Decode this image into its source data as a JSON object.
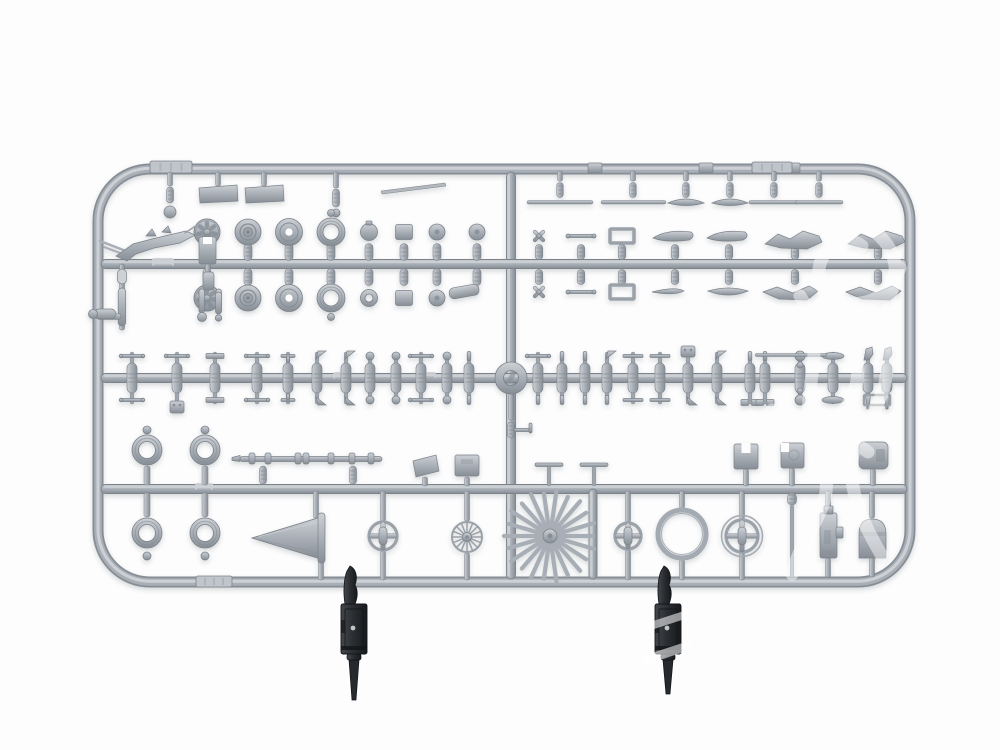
{
  "meta": {
    "description": "Product photograph of a light grey injection-moulded plastic model kit sprue on a white background. The rounded rectangular runner frame holds aircraft detail parts: spoked wheels, rimmed wheels, four rubber-style tyre rings, a propeller spinner cone, a large sunburst spoked wheel, cross-spoke wheels, struts, rods, brackets and fuselage fittings. Two dark grey machine guns are attached at the bottom edge and a faint white watermark swirl overlays the right side."
  },
  "palette": {
    "background": "#fdfdfe",
    "sprue_light": "#cdd1d6",
    "sprue_mid": "#a9afb6",
    "sprue_dark": "#878e96",
    "outline": "#7b828a",
    "tag_fill": "#c0c5cb",
    "dark_hi": "#43474c",
    "dark_mid": "#2b2e32",
    "dark_low": "#17191c",
    "watermark": "#ffffff"
  },
  "scene": {
    "frame": {
      "x": 98,
      "y": 169,
      "w": 812,
      "h": 413,
      "r": 52
    },
    "divider_x": 511,
    "runners_y": [
      264,
      378,
      489
    ],
    "right_vbar_x": 593,
    "tabs_top": [
      595,
      706,
      793
    ],
    "tags": [
      [
        150,
        161,
        42,
        12
      ],
      [
        752,
        162,
        40,
        11
      ],
      [
        196,
        576,
        36,
        11
      ]
    ],
    "marks": [
      [
        152,
        258,
        22,
        8
      ],
      [
        333,
        372,
        16,
        7
      ],
      [
        195,
        483,
        18,
        7
      ],
      [
        424,
        372,
        12,
        6
      ]
    ],
    "gear_assembly": {
      "present": true
    },
    "left_frame_parts": {
      "present": true
    },
    "row1_left": [
      {
        "t": "pinDisc",
        "x": 170
      },
      {
        "t": "plate",
        "x": 218
      },
      {
        "t": "plate",
        "x": 264
      },
      {
        "t": "pinBase",
        "x": 336
      },
      {
        "t": "blade",
        "x1": 381,
        "y1": 191,
        "x2": 445,
        "y2": 183
      }
    ],
    "row1_right": [
      {
        "t": "rod",
        "x": 560,
        "x1": 527,
        "x2": 593
      },
      {
        "t": "rod",
        "x": 633,
        "x1": 601,
        "x2": 666
      },
      {
        "t": "crescent",
        "x": 686
      },
      {
        "t": "crescent",
        "x": 730
      },
      {
        "t": "rod",
        "x": 774,
        "x1": 749,
        "x2": 799
      },
      {
        "t": "rod",
        "x": 819,
        "x1": 795,
        "x2": 843
      }
    ],
    "row2_left": [
      {
        "x": 207,
        "top": "spoked",
        "bot": "spoked"
      },
      {
        "x": 248,
        "top": "rim",
        "bot": "rim"
      },
      {
        "x": 289,
        "top": "hole",
        "bot": "hole"
      },
      {
        "x": 331,
        "top": "tire",
        "bot": "tire"
      },
      {
        "x": 369,
        "top": "round",
        "bot": "ring"
      },
      {
        "x": 404,
        "top": "plate",
        "bot": "plate"
      },
      {
        "x": 437,
        "top": "dot",
        "bot": "dot"
      },
      {
        "x": 477,
        "top": "dot",
        "bot": "cyl"
      }
    ],
    "row2_right": [
      {
        "x": 539,
        "top": "prop",
        "bot": "prop"
      },
      {
        "x": 581,
        "top": "tbar",
        "bot": "tbar"
      },
      {
        "x": 622,
        "top": "bracket",
        "bot": "bracket"
      },
      {
        "x": 675,
        "top": "blade",
        "bot": "thin"
      },
      {
        "x": 729,
        "top": "blade",
        "bot": "boat"
      },
      {
        "x": 795,
        "top": "wing",
        "bot": "wing2"
      },
      {
        "x": 878,
        "top": "wing",
        "bot": "wing2"
      }
    ],
    "row3_left": [
      [
        132,
        "T",
        "T"
      ],
      [
        177,
        "T",
        "box"
      ],
      [
        215,
        "plate",
        "plate"
      ],
      [
        257,
        "T",
        "T"
      ],
      [
        288,
        "I",
        "I"
      ],
      [
        317,
        "fin",
        "fin"
      ],
      [
        346,
        "fin",
        "fin"
      ],
      [
        370,
        "ball",
        "ball"
      ],
      [
        396,
        "ball",
        "ball"
      ],
      [
        421,
        "T",
        "T"
      ],
      [
        447,
        "ball",
        "ball"
      ],
      [
        469,
        "pin",
        "pin"
      ]
    ],
    "row3_right": [
      [
        538,
        "T",
        "pin"
      ],
      [
        562,
        "pin",
        "pin"
      ],
      [
        585,
        "pin",
        "pin"
      ],
      [
        607,
        "fin",
        "pin"
      ],
      [
        633,
        "bar",
        "bar"
      ],
      [
        660,
        "bar",
        "bar"
      ],
      [
        688,
        "box2",
        "fin"
      ],
      [
        717,
        "fin",
        "fin"
      ],
      [
        750,
        "pin",
        "H"
      ],
      [
        765,
        "pin",
        "H"
      ],
      [
        800,
        "ballBig",
        "ballBig"
      ],
      [
        833,
        "oval",
        "oval"
      ],
      [
        868,
        "hook",
        "taper"
      ],
      [
        887,
        "hook",
        "taper"
      ]
    ],
    "row3_rod": {
      "x1": 755,
      "x2": 827,
      "y": 355
    },
    "row4_tires_x": [
      147,
      205
    ],
    "row4_rod": {
      "x1": 240,
      "x2": 382,
      "y": 459,
      "collars": [
        252,
        268,
        298,
        306,
        331,
        352,
        371
      ]
    },
    "row4_above": [
      {
        "t": "plate425",
        "x": 425
      },
      {
        "t": "block",
        "x": 467
      },
      {
        "t": "miniT",
        "x": 549
      },
      {
        "t": "miniT",
        "x": 594
      },
      {
        "t": "ubracket",
        "x": 746
      },
      {
        "t": "notchbox",
        "x": 792
      },
      {
        "t": "slotbox",
        "x": 873
      }
    ],
    "row4_below": [
      {
        "t": "cone",
        "x": 286
      },
      {
        "t": "cross",
        "x": 383,
        "r": 14
      },
      {
        "t": "multispoke",
        "x": 467,
        "r": 15
      },
      {
        "t": "sunburst",
        "x": 550,
        "r": 46
      },
      {
        "t": "cross",
        "x": 628,
        "r": 13
      },
      {
        "t": "bigring",
        "x": 682,
        "r": 24
      },
      {
        "t": "crossring",
        "x": 742,
        "r": 16
      },
      {
        "t": "pincol",
        "x": 792
      },
      {
        "t": "gungrey",
        "x": 828
      },
      {
        "t": "bell",
        "x": 872
      }
    ],
    "guns_black": [
      {
        "x": 354,
        "barrel_end": 700,
        "stripes": false
      },
      {
        "x": 668,
        "barrel_end": 694,
        "stripes": true
      }
    ],
    "watermark": {
      "opacity": 0.48,
      "strokes": [
        "M862 224 C900 242 908 286 872 300 C840 312 812 292 820 264 C826 242 850 236 862 246",
        "M900 268 C872 324 906 368 868 420 C836 464 856 512 882 556",
        "M800 296 C836 352 788 404 820 462 C842 500 802 532 792 574",
        "M838 332 C868 356 862 396 832 424",
        "M772 410 C800 436 840 430 868 452"
      ],
      "stripes": [
        {
          "x": 646,
          "y": 616,
          "w": 46,
          "h": 8,
          "rot": -18
        },
        {
          "x": 641,
          "y": 648,
          "w": 54,
          "h": 9,
          "rot": -18
        }
      ]
    }
  }
}
